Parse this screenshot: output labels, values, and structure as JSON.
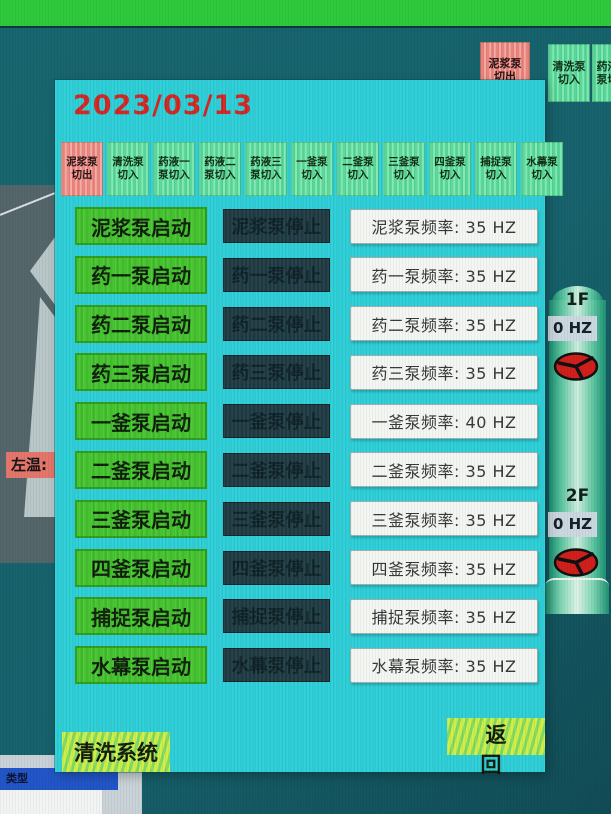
{
  "background": {
    "top_buttons": [
      {
        "label": "泥浆泵\n切出",
        "state": "out"
      },
      {
        "label": "清洗泵\n切入",
        "state": "in"
      },
      {
        "label": "药液一\n泵切入",
        "state": "in"
      }
    ],
    "left_label": "左温:",
    "pipe": {
      "sections": [
        {
          "floor": "1F",
          "freq": "0 HZ"
        },
        {
          "floor": "2F",
          "freq": "0 HZ"
        }
      ]
    },
    "bottom_window": {
      "title": "类型"
    }
  },
  "dialog": {
    "date": "2023/03/13",
    "tabs": [
      {
        "label": "泥浆泵\n切出",
        "state": "out"
      },
      {
        "label": "清洗泵\n切入",
        "state": "in"
      },
      {
        "label": "药液一\n泵切入",
        "state": "in"
      },
      {
        "label": "药液二\n泵切入",
        "state": "in"
      },
      {
        "label": "药液三\n泵切入",
        "state": "in"
      },
      {
        "label": "一釜泵\n切入",
        "state": "in"
      },
      {
        "label": "二釜泵\n切入",
        "state": "in"
      },
      {
        "label": "三釜泵\n切入",
        "state": "in"
      },
      {
        "label": "四釜泵\n切入",
        "state": "in"
      },
      {
        "label": "捕捉泵\n切入",
        "state": "in"
      },
      {
        "label": "水幕泵\n切入",
        "state": "in"
      }
    ],
    "rows": [
      {
        "start": "泥浆泵启动",
        "stop": "泥浆泵停止",
        "freq": "泥浆泵频率: 35 HZ"
      },
      {
        "start": "药一泵启动",
        "stop": "药一泵停止",
        "freq": "药一泵频率: 35 HZ"
      },
      {
        "start": "药二泵启动",
        "stop": "药二泵停止",
        "freq": "药二泵频率: 35 HZ"
      },
      {
        "start": "药三泵启动",
        "stop": "药三泵停止",
        "freq": "药三泵频率: 35 HZ"
      },
      {
        "start": "一釜泵启动",
        "stop": "一釜泵停止",
        "freq": "一釜泵频率: 40 HZ"
      },
      {
        "start": "二釜泵启动",
        "stop": "二釜泵停止",
        "freq": "二釜泵频率: 35 HZ"
      },
      {
        "start": "三釜泵启动",
        "stop": "三釜泵停止",
        "freq": "三釜泵频率: 35 HZ"
      },
      {
        "start": "四釜泵启动",
        "stop": "四釜泵停止",
        "freq": "四釜泵频率: 35 HZ"
      },
      {
        "start": "捕捉泵启动",
        "stop": "捕捉泵停止",
        "freq": "捕捉泵频率: 35 HZ"
      },
      {
        "start": "水幕泵启动",
        "stop": "水幕泵停止",
        "freq": "水幕泵频率: 35 HZ"
      }
    ],
    "footer": {
      "system_label": "清洗系统",
      "back_label": "返 回"
    }
  },
  "colors": {
    "top_strip_green": "#2fc93c",
    "dialog_cyan": "#2acdd6",
    "start_green": "#47c72f",
    "start_green_border": "#2b9c1a",
    "stop_dark_bg": "#1e3941",
    "stop_dark_text": "#0b2026",
    "freq_bg": "#f4f6f2",
    "freq_text": "#323436",
    "date_red": "#d02420",
    "tab_green": "#57d695",
    "tab_green_light": "#7ee9b4",
    "tab_pink": "#ea837b",
    "tab_pink_light": "#f3a9a1",
    "action_stripe_a": "#cdee45",
    "action_stripe_b": "#7fd95e",
    "pipe_green_dark": "#1c8f72",
    "pipe_green_light": "#cdeede",
    "fan_red": "#cf201c",
    "freq0_bg": "#ccd8df",
    "left_panel_gray": "#55666b",
    "left_panel_light": "#b9c7c9",
    "temp_label_pink": "#e4766c",
    "window_blue": "#2256c8"
  }
}
